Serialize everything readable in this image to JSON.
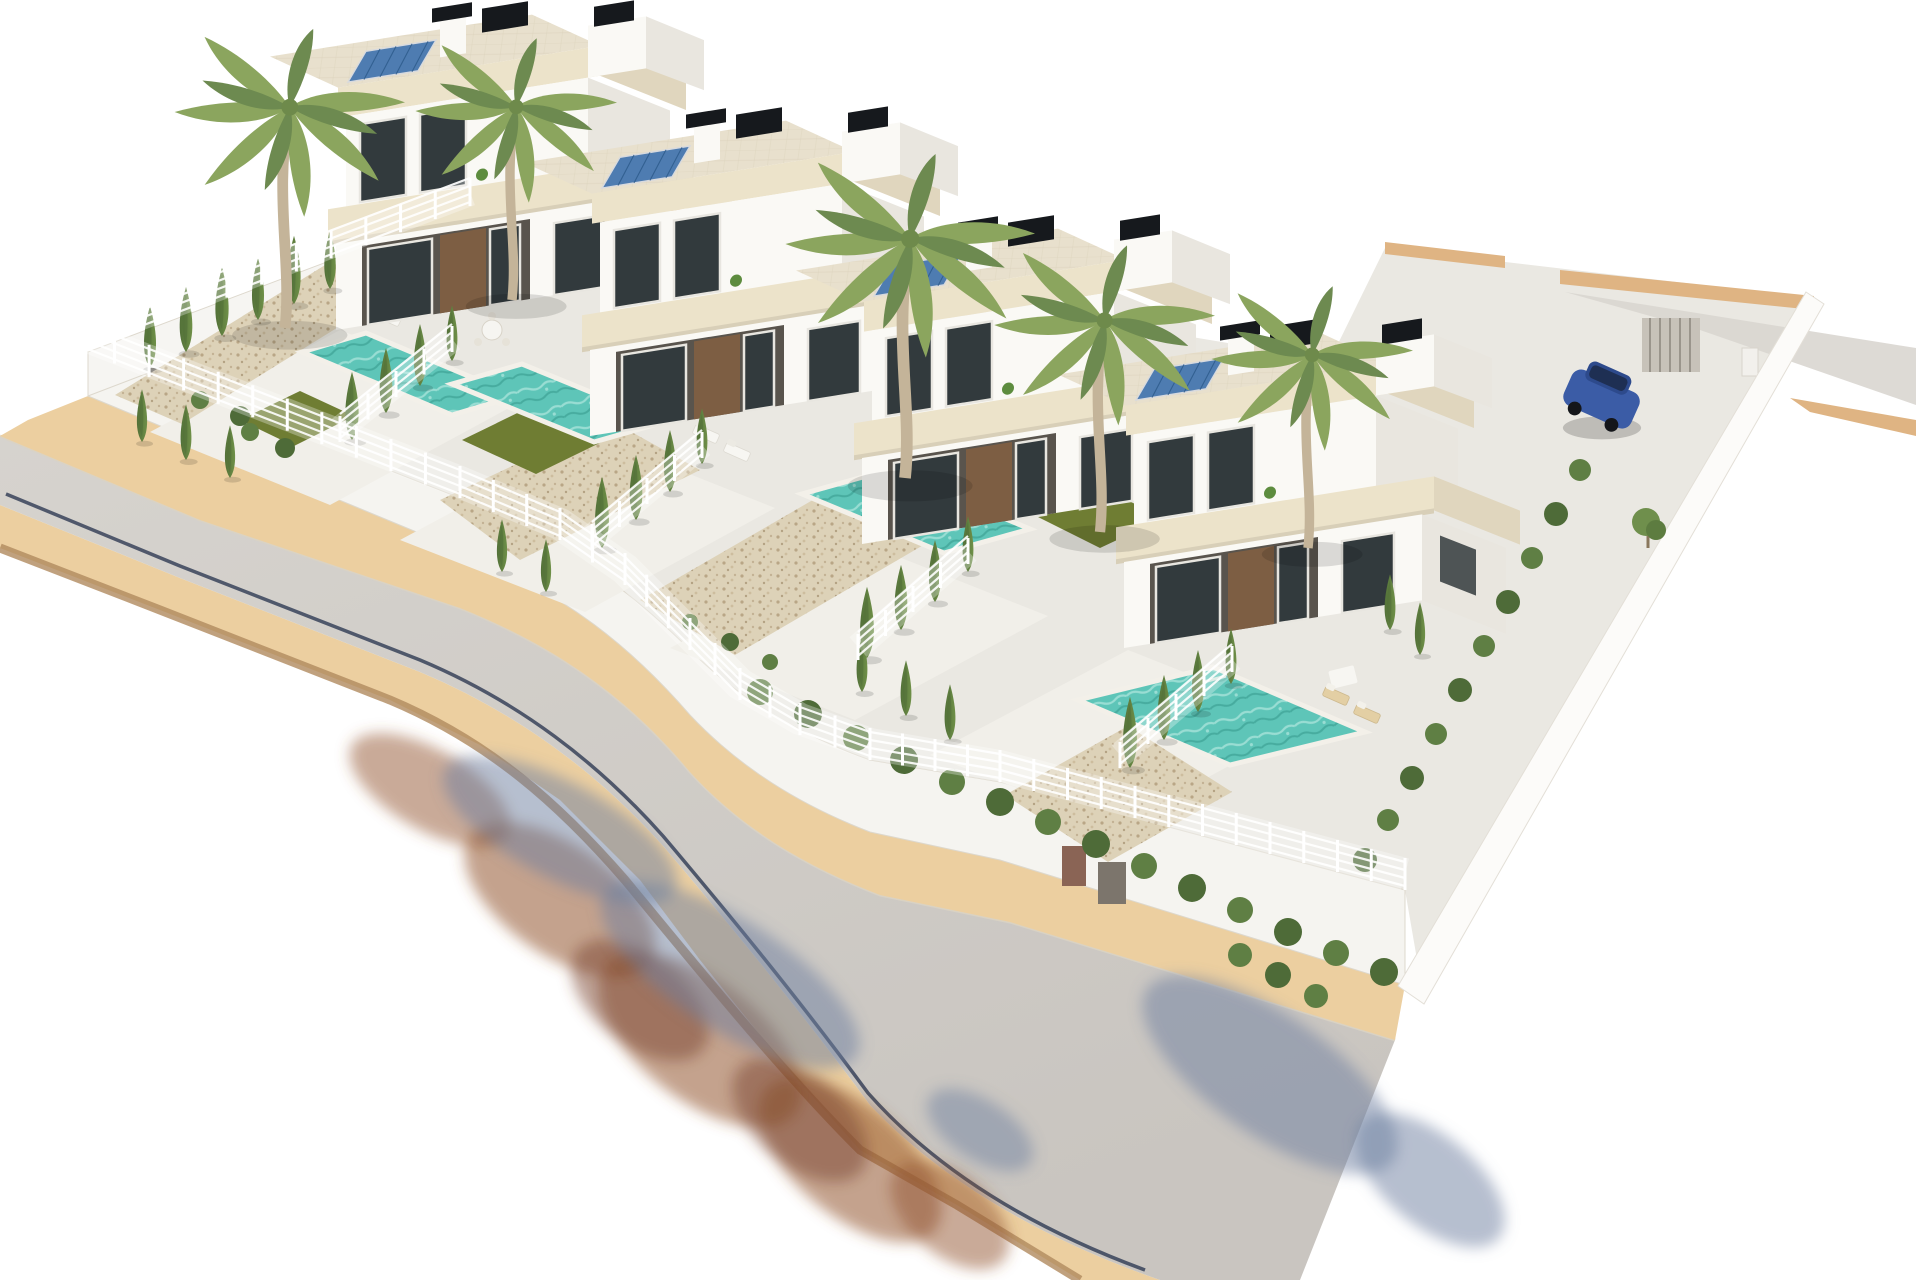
{
  "meta": {
    "title": "Aerial 3D architectural render of a row of four modern villas with private pools",
    "render_style": "photorealistic CGI on white background"
  },
  "scene": {
    "development": {
      "villa_count": 4,
      "villas": [
        {
          "name": "villa-1",
          "features": [
            "two-storey white cube villa",
            "flat travertine roof terrace",
            "rooftop solar panel",
            "black rooftop units",
            "brown wood entry door",
            "private pool",
            "two white sun loungers",
            "two yellow deck chairs",
            "round patio table",
            "gravel garden with cypress trees"
          ]
        },
        {
          "name": "villa-2",
          "features": [
            "two-storey white cube villa",
            "flat travertine roof terrace",
            "rooftop solar panel",
            "black rooftop units",
            "covered porch with outdoor dining table",
            "private pool",
            "green lawn patch",
            "two white sun loungers",
            "gravel bed"
          ]
        },
        {
          "name": "villa-3",
          "features": [
            "two-storey white cube villa",
            "flat travertine roof terrace",
            "rooftop solar panel",
            "black rooftop units",
            "white garden sofa set with coffee table",
            "private pool",
            "green lawn patch",
            "large gravel garden",
            "balcony bistro table"
          ]
        },
        {
          "name": "villa-4",
          "features": [
            "two-storey white cube villa on corner plot",
            "flat travertine roof terrace",
            "rooftop solar panel",
            "black rooftop units",
            "rattan garden sofa",
            "largest swimming pool",
            "two tan sun loungers",
            "two green lawn areas",
            "roof terrace bistro table",
            "driveway with parked car"
          ]
        }
      ],
      "pools": 4,
      "lawns": 4,
      "perimeter": {
        "front": "white rendered wall topped with white slatted mesh fence",
        "left": "white wall with fence and cypress row",
        "right": "tall plain white wall with hedge inside",
        "back": "wall with sand-coloured coping and service gate",
        "street_wall_details": [
          "utility doors",
          "small vents"
        ]
      }
    },
    "street": {
      "road": "curved grey asphalt road wrapping the plot",
      "sidewalks": "sand-coloured paver sidewalks on both sides",
      "curb_line": "dark gutter line along lower road edge",
      "shadows": [
        "blue-grey tree shadows cast on road",
        "red-brown tree shadows on brick paver apron"
      ]
    },
    "landscape": {
      "palm_trees": 5,
      "cypress_trees": 32,
      "hedge_shrub_rows": 5,
      "gravel_beds": 4
    },
    "vehicle": {
      "type": "compact hatchback",
      "color_name": "blue",
      "location": "driveway beside villa-4"
    },
    "furniture": {
      "sun_loungers": 6,
      "garden_sofas": 2,
      "tables": 4
    }
  },
  "colors": {
    "background": "#ffffff",
    "road": "#c9c5c0",
    "road_far": "#d6d3ce",
    "sidewalk": "#eccfa0",
    "sidewalk_edge": "#b08a5e",
    "brick_shadow": "#94552f",
    "tree_shadow": "#6d7fa0",
    "plot": "#eae8e2",
    "terrace": "#f1efe9",
    "villa_white": "#faf9f5",
    "villa_side": "#e9e6df",
    "fascia": "#ece3ca",
    "fascia_side": "#e0d6be",
    "roof": "#e8e0cd",
    "roof_line": "#d9d0ba",
    "glass": "#323a3d",
    "frame": "#e8e6e0",
    "wood": "#7d5e43",
    "porch": "#59544d",
    "pool": "#5ec5b8",
    "pool_light": "#a8e4da",
    "pool_dark": "#3da294",
    "coping": "#f3f0e9",
    "lawn": "#6f7d33",
    "gravel": "#ddd2b8",
    "gravel_dot": "#b9a686",
    "cypress": "#527038",
    "cypress_light": "#6f9048",
    "palm": "#8ba55e",
    "palm_dark": "#6d8a50",
    "trunk": "#c4b499",
    "hedge": "#4e6b38",
    "fence": "#ffffff",
    "wall_cap": "#dfb483",
    "back_band": "#d9d6d0",
    "solar": "#4e7cb1",
    "solar_grid": "#2c5a8a",
    "ac": "#16191d",
    "car": "#3b5ca6",
    "car_dark": "#2d4a8c",
    "car_glass": "#1d2d50"
  }
}
